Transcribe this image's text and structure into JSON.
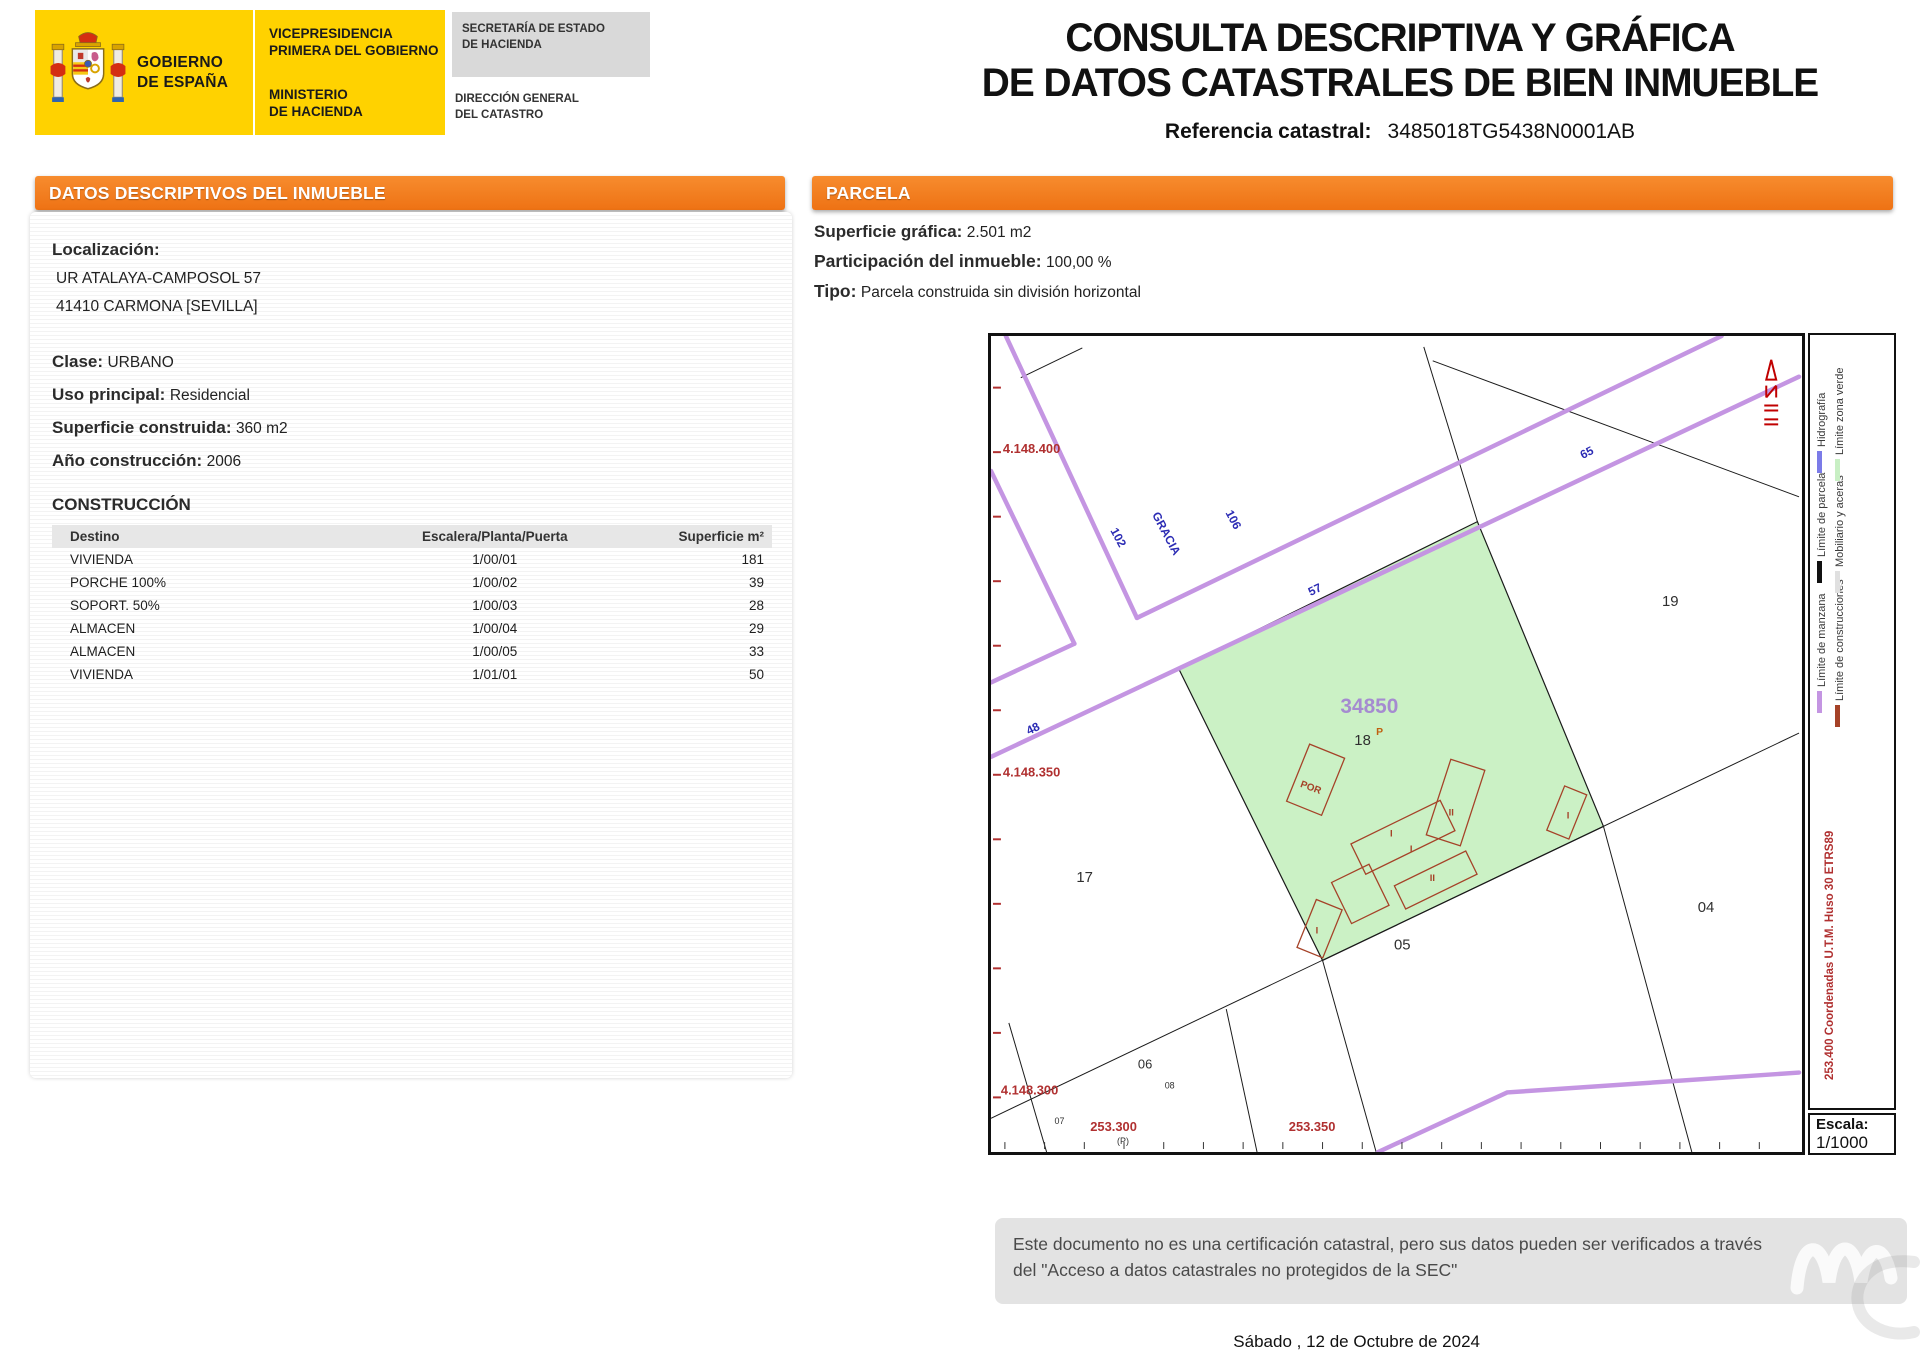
{
  "header": {
    "gobierno": "GOBIERNO\nDE ESPAÑA",
    "vicepresidencia": "VICEPRESIDENCIA\nPRIMERA DEL GOBIERNO",
    "ministerio": "MINISTERIO\nDE HACIENDA",
    "secretaria": "SECRETARÍA DE ESTADO\nDE HACIENDA",
    "direccion": "DIRECCIÓN GENERAL\nDEL CATASTRO",
    "title_line1": "CONSULTA DESCRIPTIVA Y GRÁFICA",
    "title_line2": "DE DATOS CATASTRALES DE BIEN INMUEBLE",
    "ref_label": "Referencia catastral:",
    "ref_value": "3485018TG5438N0001AB"
  },
  "left_panel": {
    "header": "DATOS DESCRIPTIVOS DEL INMUEBLE",
    "localizacion_label": "Localización:",
    "address_line1": "UR ATALAYA-CAMPOSOL 57",
    "address_line2": "41410 CARMONA [SEVILLA]",
    "clase_label": "Clase:",
    "clase_value": "URBANO",
    "uso_label": "Uso principal:",
    "uso_value": "Residencial",
    "superficie_label": "Superficie construida:",
    "superficie_value": "360 m2",
    "anio_label": "Año construcción:",
    "anio_value": "2006",
    "construccion_title": "CONSTRUCCIÓN",
    "table": {
      "headers": [
        "Destino",
        "Escalera/Planta/Puerta",
        "Superficie m²"
      ],
      "rows": [
        [
          "VIVIENDA",
          "1/00/01",
          "181"
        ],
        [
          "PORCHE 100%",
          "1/00/02",
          "39"
        ],
        [
          "SOPORT. 50%",
          "1/00/03",
          "28"
        ],
        [
          "ALMACEN",
          "1/00/04",
          "29"
        ],
        [
          "ALMACEN",
          "1/00/05",
          "33"
        ],
        [
          "VIVIENDA",
          "1/01/01",
          "50"
        ]
      ]
    }
  },
  "right_panel": {
    "header": "PARCELA",
    "superficie_label": "Superficie gráfica:",
    "superficie_value": "2.501 m2",
    "participacion_label": "Participación del inmueble:",
    "participacion_value": "100,00 %",
    "tipo_label": "Tipo:",
    "tipo_value": "Parcela construida sin división horizontal"
  },
  "map": {
    "labels": [
      "4.148.400",
      "4.148.350",
      "4.148.300",
      "253.300",
      "253.350",
      "(P)",
      "106",
      "GRACIA",
      "102",
      "57",
      "65",
      "48",
      "34850",
      "18",
      "P",
      "POR",
      "17",
      "19",
      "04",
      "05",
      "06",
      "08",
      "07"
    ],
    "building_labels": [
      "II",
      "I",
      "I",
      "II",
      "I",
      "I"
    ],
    "colors": {
      "road": "#C495E2",
      "green_zone": "#CBF1C5",
      "construction": "#A54228",
      "parcel_line": "#1a1a1a",
      "coord_red": "#B03030",
      "street_blue": "#2B2BB4",
      "parcel_number_purple": "#A58BD0"
    },
    "legend": {
      "items": [
        {
          "label": "Límite de manzana",
          "color": "#C495E2"
        },
        {
          "label": "Límite de construcciones",
          "color": "#A54228"
        },
        {
          "label": "Límite de parcela",
          "color": "#111111"
        },
        {
          "label": "Mobiliario y aceras",
          "color": "#E0E0E0"
        },
        {
          "label": "Hidrografía",
          "color": "#7B7BE8"
        },
        {
          "label": "Límite zona verde",
          "color": "#C8EFC4"
        }
      ],
      "utm": "253.400 Coordenadas U.T.M. Huso 30 ETRS89",
      "escala_label": "Escala:",
      "escala_value": "1/1000"
    }
  },
  "footer": {
    "disclaimer": "Este documento no es una certificación catastral, pero sus datos pueden ser verificados a través del \"Acceso a datos catastrales no protegidos de la SEC\"",
    "date": "Sábado , 12 de Octubre de 2024"
  }
}
